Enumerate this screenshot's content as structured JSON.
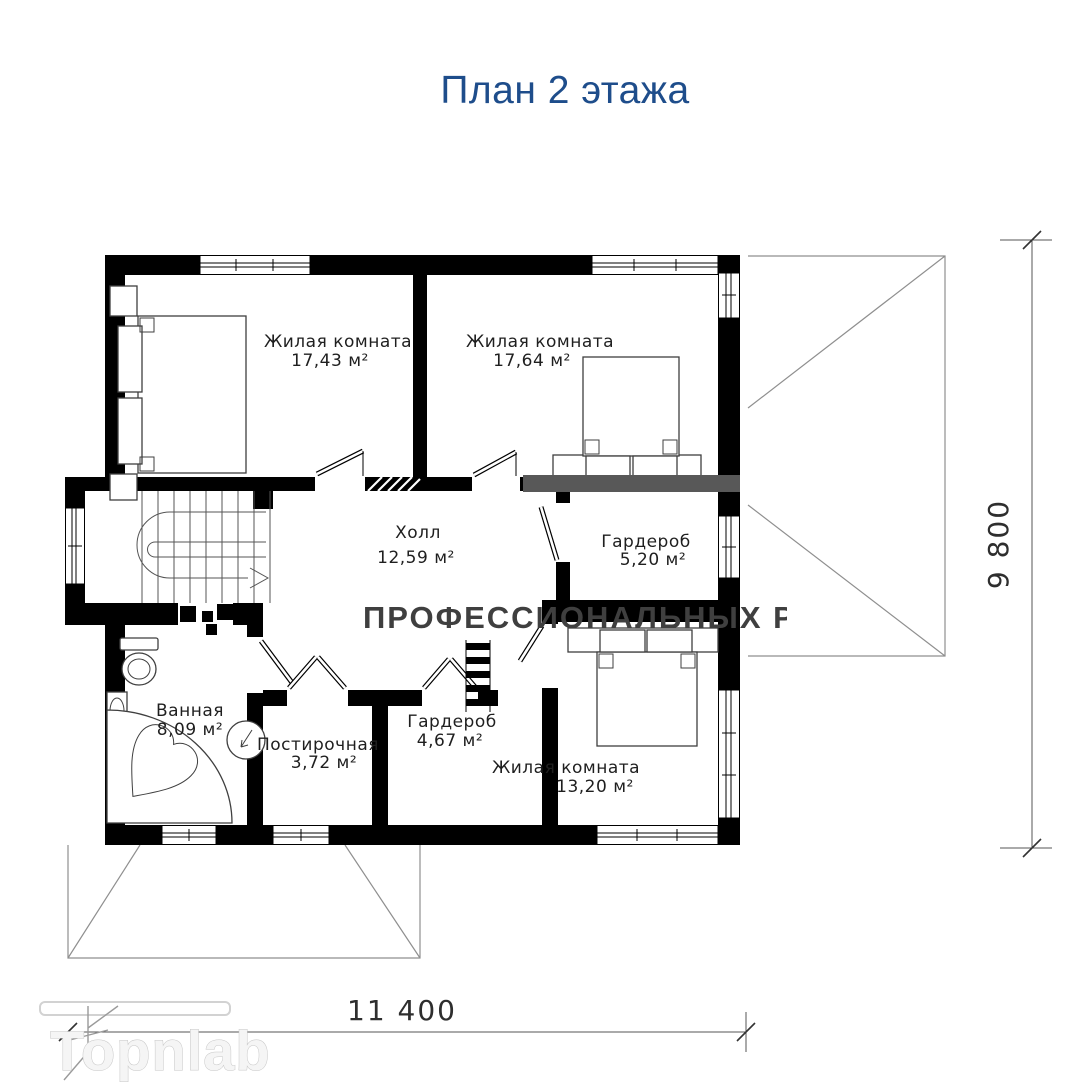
{
  "title": "План 2 этажа",
  "rooms": [
    {
      "id": "living-1",
      "name": "Жилая комната",
      "area": "17,43 м²"
    },
    {
      "id": "living-2",
      "name": "Жилая комната",
      "area": "17,64 м²"
    },
    {
      "id": "hall",
      "name": "Холл",
      "area": "12,59 м²"
    },
    {
      "id": "wardrobe-1",
      "name": "Гардероб",
      "area": "5,20 м²"
    },
    {
      "id": "bathroom",
      "name": "Ванная",
      "area": "8,09 м²"
    },
    {
      "id": "laundry",
      "name": "Постирочная",
      "area": "3,72 м²"
    },
    {
      "id": "wardrobe-2",
      "name": "Гардероб",
      "area": "4,67 м²"
    },
    {
      "id": "living-3",
      "name": "Жилая комната",
      "area": "13,20 м²"
    }
  ],
  "dimensions": {
    "horizontal": "11 400",
    "vertical": "9 800"
  },
  "watermark": {
    "line": "ПРОФЕССИОНАЛЬНЫХ РИЕЛТОРОВ",
    "brand": "Topnlab"
  },
  "colors": {
    "title": "#1e4d8b",
    "wall": "#000000",
    "watermark_band": "#585858"
  }
}
